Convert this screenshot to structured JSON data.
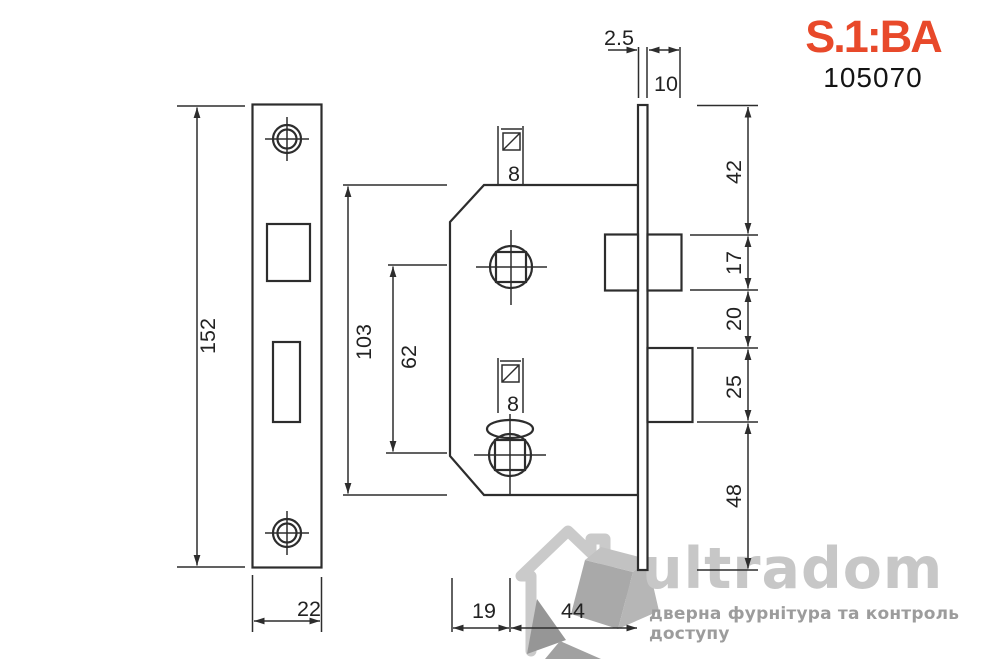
{
  "logo": {
    "text": "S.1:BA",
    "code": "105070",
    "color": "#e8492a"
  },
  "watermark": {
    "brand": "ultradom",
    "tagline": "дверна фурнітура та контроль доступу"
  },
  "dimensions": {
    "faceplate": {
      "height": "152",
      "width": "22"
    },
    "body": {
      "height": "103",
      "hole_spacing": "62",
      "square_top": "8",
      "square_bottom": "8",
      "edge_to_spindle": "19",
      "backset": "44"
    },
    "edge": {
      "plate_thickness": "2.5",
      "latch_protrusion": "10",
      "top_to_latch": "42",
      "latch_height": "17",
      "latch_to_deadbolt": "20",
      "deadbolt_height": "25",
      "deadbolt_to_bottom": "48"
    }
  }
}
